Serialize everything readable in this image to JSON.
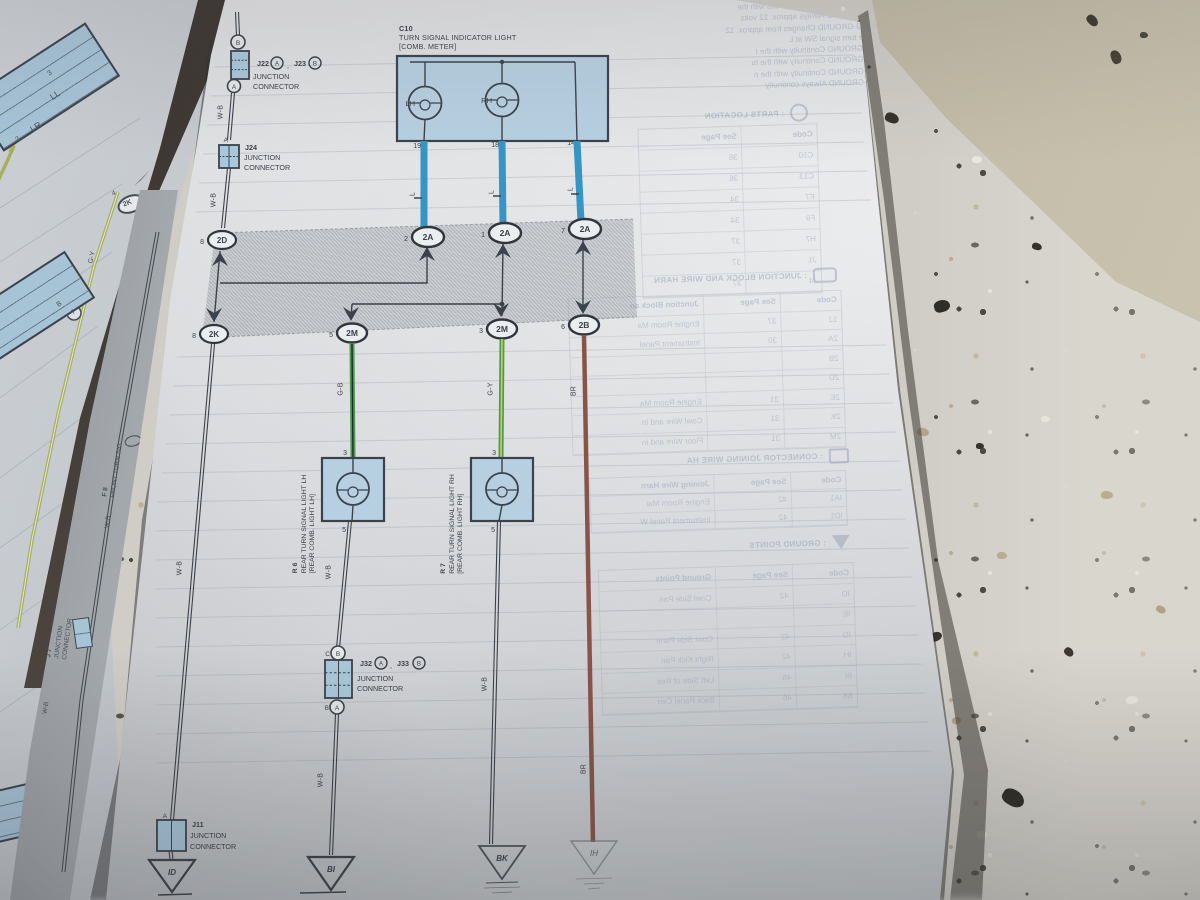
{
  "diagram": {
    "c10": {
      "code": "C10",
      "line1": "TURN SIGNAL INDICATOR LIGHT",
      "line2": "[COMB.  METER]",
      "lh": "LH",
      "rh": "RH",
      "pin19": "19",
      "pin18": "18",
      "pin14": "14"
    },
    "wire_labels": {
      "l": "L",
      "wb": "W-B",
      "gb": "G-B",
      "gy": "G-Y",
      "br": "BR"
    },
    "ovals": [
      {
        "n": "2",
        "c": "2A"
      },
      {
        "n": "1",
        "c": "2A"
      },
      {
        "n": "7",
        "c": "2A"
      },
      {
        "n": "8",
        "c": "2D"
      },
      {
        "n": "8",
        "c": "2K"
      },
      {
        "n": "5",
        "c": "2M"
      },
      {
        "n": "3",
        "c": "2M"
      },
      {
        "n": "6",
        "c": "2B"
      }
    ],
    "j22": {
      "name": "J22",
      "a": "A",
      "sep": ",",
      "name2": "J23",
      "b": "B",
      "l1": "JUNCTION",
      "l2": "CONNECTOR",
      "top_circle": "B",
      "mid_circle": "A",
      "wire_pin": "A"
    },
    "j24": {
      "name": "J24",
      "l1": "JUNCTION",
      "l2": "CONNECTOR"
    },
    "j32": {
      "name": "J32",
      "a": "A",
      "sep": ",",
      "name2": "J33",
      "b": "B",
      "l1": "JUNCTION",
      "l2": "CONNECTOR",
      "top_pin": "C",
      "top_circle": "B",
      "bottom_pin": "B",
      "bottom_circle": "A"
    },
    "j11": {
      "name": "J11",
      "l1": "JUNCTION",
      "l2": "CONNECTOR",
      "wire_pin": "A"
    },
    "r6": {
      "code": "R 6",
      "line1": "REAR TURN SIGNAL LIGHT LH",
      "line2": "[REAR COMB.  LIGHT LH]",
      "pin_top": "3",
      "pin_bottom": "5"
    },
    "r7": {
      "code": "R 7",
      "line1": "REAR TURN SIGNAL LIGHT RH",
      "line2": "[REAR COMB.  LIGHT RH]",
      "pin_top": "3",
      "pin_bottom": "5"
    },
    "grounds": {
      "id": "ID",
      "bi": "BI",
      "bk": "BK",
      "ih": "IH"
    }
  },
  "left_page": {
    "box1": {
      "pin3": "3",
      "ll": "LL",
      "lr": "LR",
      "pin2": "2"
    },
    "gy": "G-Y",
    "b": "B",
    "a": "A",
    "oval": {
      "n": "4",
      "c": "2K"
    },
    "f8": {
      "code": "F 8",
      "name": "FRONT TURN SIG"
    },
    "wb": "W-B",
    "j7": {
      "code": "J 7",
      "l1": "JUNCTION",
      "l2": "CONNECTOR"
    }
  },
  "bleedthrough": {
    "notes": [
      "4-GROUND   Approx. 12 volts with the",
      "1-GROUND   Always approx. 12 volts",
      "2, 3-GROUND   Changes from approx. 12",
      "the turn signal SW at L",
      "5-GROUND   Continuity with the t",
      "6-GROUND   Continuity with the tu",
      "8-GROUND   Continuity with the n",
      "7-GROUND   Always continuity"
    ],
    "parts_location": {
      "title": ": PARTS LOCATION",
      "cols": [
        "Code",
        "See Page"
      ],
      "rows": [
        [
          "C10",
          "36"
        ],
        [
          "C13",
          "36"
        ],
        [
          "F7",
          "34"
        ],
        [
          "F9",
          "34"
        ],
        [
          "H7",
          "37"
        ],
        [
          "J1",
          "37"
        ],
        [
          "J4",
          "37"
        ]
      ]
    },
    "junction_block": {
      "title": ": JUNCTION BLOCK AND WIRE HARN",
      "cols": [
        "Code",
        "See Page",
        "Junction Block an"
      ],
      "rows": [
        [
          "1J",
          "37",
          "Engine Room Ma"
        ],
        [
          "2A",
          "30",
          "Instrument Panel"
        ],
        [
          "2B",
          "",
          ""
        ],
        [
          "2D",
          "",
          ""
        ],
        [
          "2E",
          "31",
          "Engine Room Ma"
        ],
        [
          "2K",
          "31",
          "Cowl Wire and In"
        ],
        [
          "2M",
          "31",
          "Floor Wire and In"
        ]
      ]
    },
    "connector_joining": {
      "title": ": CONNECTOR JOINING WIRE HA",
      "cols": [
        "Code",
        "See Page",
        "Joining Wire Harn"
      ],
      "rows": [
        [
          "IA1",
          "42",
          "Engine Room Mai"
        ],
        [
          "ID1",
          "42",
          "Instrument Panel W"
        ]
      ]
    },
    "ground_points": {
      "title": ": GROUND POINTS",
      "cols": [
        "Code",
        "See Page",
        "Ground Points"
      ],
      "rows": [
        [
          "ID",
          "42",
          "Cowl Side Pan"
        ],
        [
          "IE",
          "",
          ""
        ],
        [
          "IG",
          "42",
          "Cowl Side Pane"
        ],
        [
          "IH",
          "42",
          "Right Kick Pan"
        ],
        [
          "BI",
          "46",
          "Left Side of Rea"
        ],
        [
          "BK",
          "46",
          "Back Panel Cen"
        ]
      ]
    }
  }
}
